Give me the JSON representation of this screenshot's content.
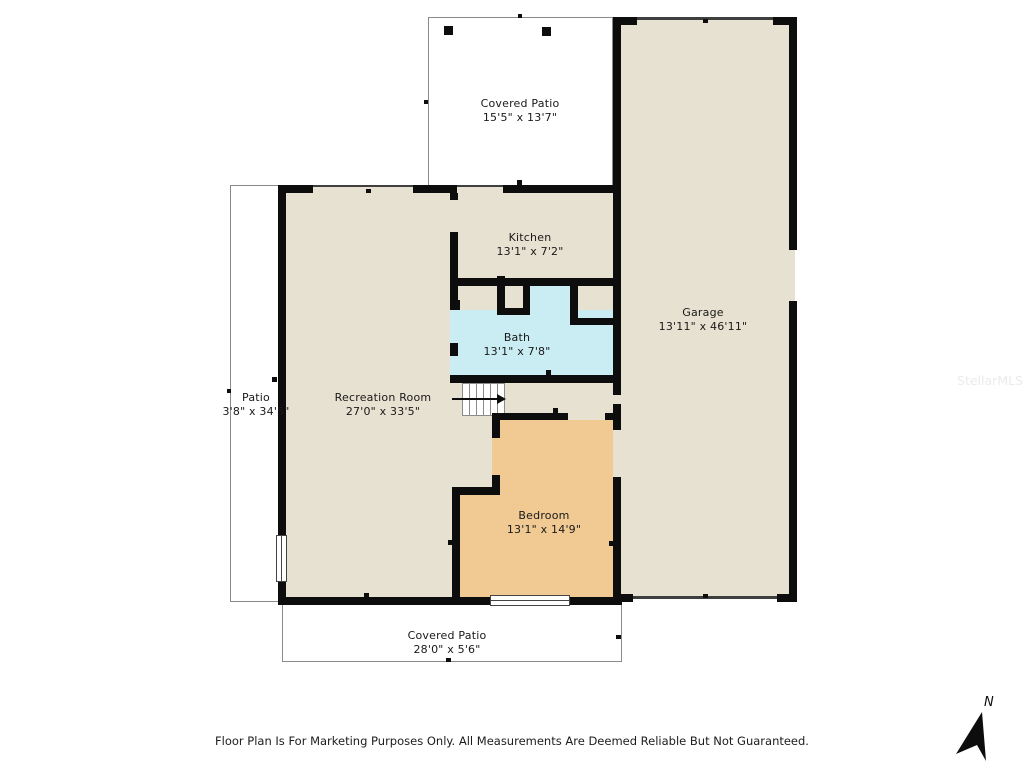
{
  "rooms": {
    "covered_patio_top": {
      "name": "Covered Patio",
      "dims": "15'5\" x 13'7\""
    },
    "kitchen": {
      "name": "Kitchen",
      "dims": "13'1\" x 7'2\""
    },
    "garage": {
      "name": "Garage",
      "dims": "13'11\" x 46'11\""
    },
    "bath": {
      "name": "Bath",
      "dims": "13'1\" x 7'8\""
    },
    "patio_left": {
      "name": "Patio",
      "dims": "3'8\" x 34'5\""
    },
    "recreation_room": {
      "name": "Recreation Room",
      "dims": "27'0\" x 33'5\""
    },
    "bedroom": {
      "name": "Bedroom",
      "dims": "13'1\" x 14'9\""
    },
    "covered_patio_bottom": {
      "name": "Covered Patio",
      "dims": "28'0\" x 5'6\""
    }
  },
  "footer": {
    "disclaimer": "Floor Plan Is For Marketing Purposes Only. All Measurements Are Deemed Reliable But Not Guaranteed."
  },
  "compass": {
    "north_label": "N"
  },
  "watermark": "StellarMLS",
  "colors": {
    "background": "#ffffff",
    "wall": "#0d0d0d",
    "interior": "#e7e1d1",
    "bath": "#c9edf3",
    "bedroom": "#f0ca92",
    "patio_outline": "#8a8a8a"
  }
}
